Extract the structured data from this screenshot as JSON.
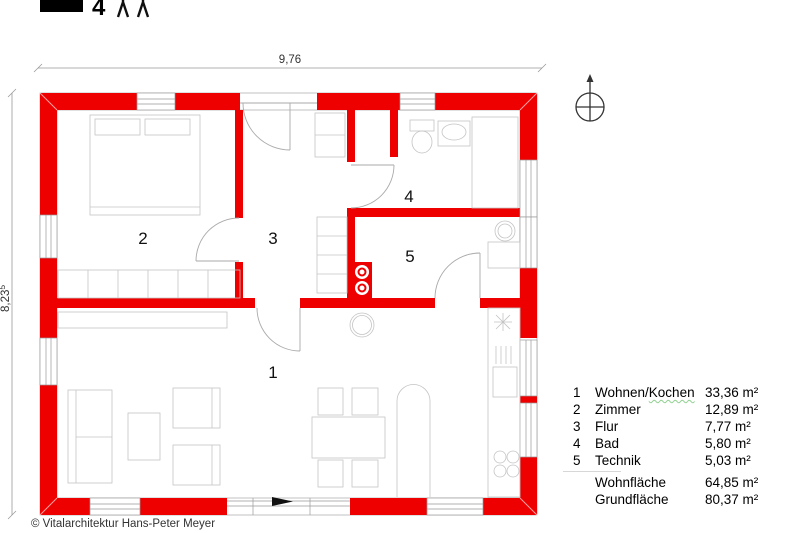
{
  "header": {
    "occupant_count": "4"
  },
  "dimensions": {
    "width": "9,76",
    "height_main": "8,23",
    "height_sup": "5"
  },
  "legend": {
    "rows": [
      {
        "num": "1",
        "label": "Wohnen/",
        "label_marked": "Kochen",
        "area": "33,36 m²"
      },
      {
        "num": "2",
        "label": "Zimmer",
        "label_marked": "",
        "area": "12,89 m²"
      },
      {
        "num": "3",
        "label": "Flur",
        "label_marked": "",
        "area": "7,77 m²"
      },
      {
        "num": "4",
        "label": "Bad",
        "label_marked": "",
        "area": "5,80 m²"
      },
      {
        "num": "5",
        "label": "Technik",
        "label_marked": "",
        "area": "5,03 m²"
      }
    ],
    "totals": [
      {
        "label": "Wohnfläche",
        "area": "64,85 m²"
      },
      {
        "label": "Grundfläche",
        "area": "80,37 m²"
      }
    ]
  },
  "footer": {
    "copyright": "© Vitalarchitektur Hans-Peter Meyer"
  },
  "colors": {
    "wall_red": "#ee0000",
    "spellcheck_green": "#8fd08f"
  }
}
